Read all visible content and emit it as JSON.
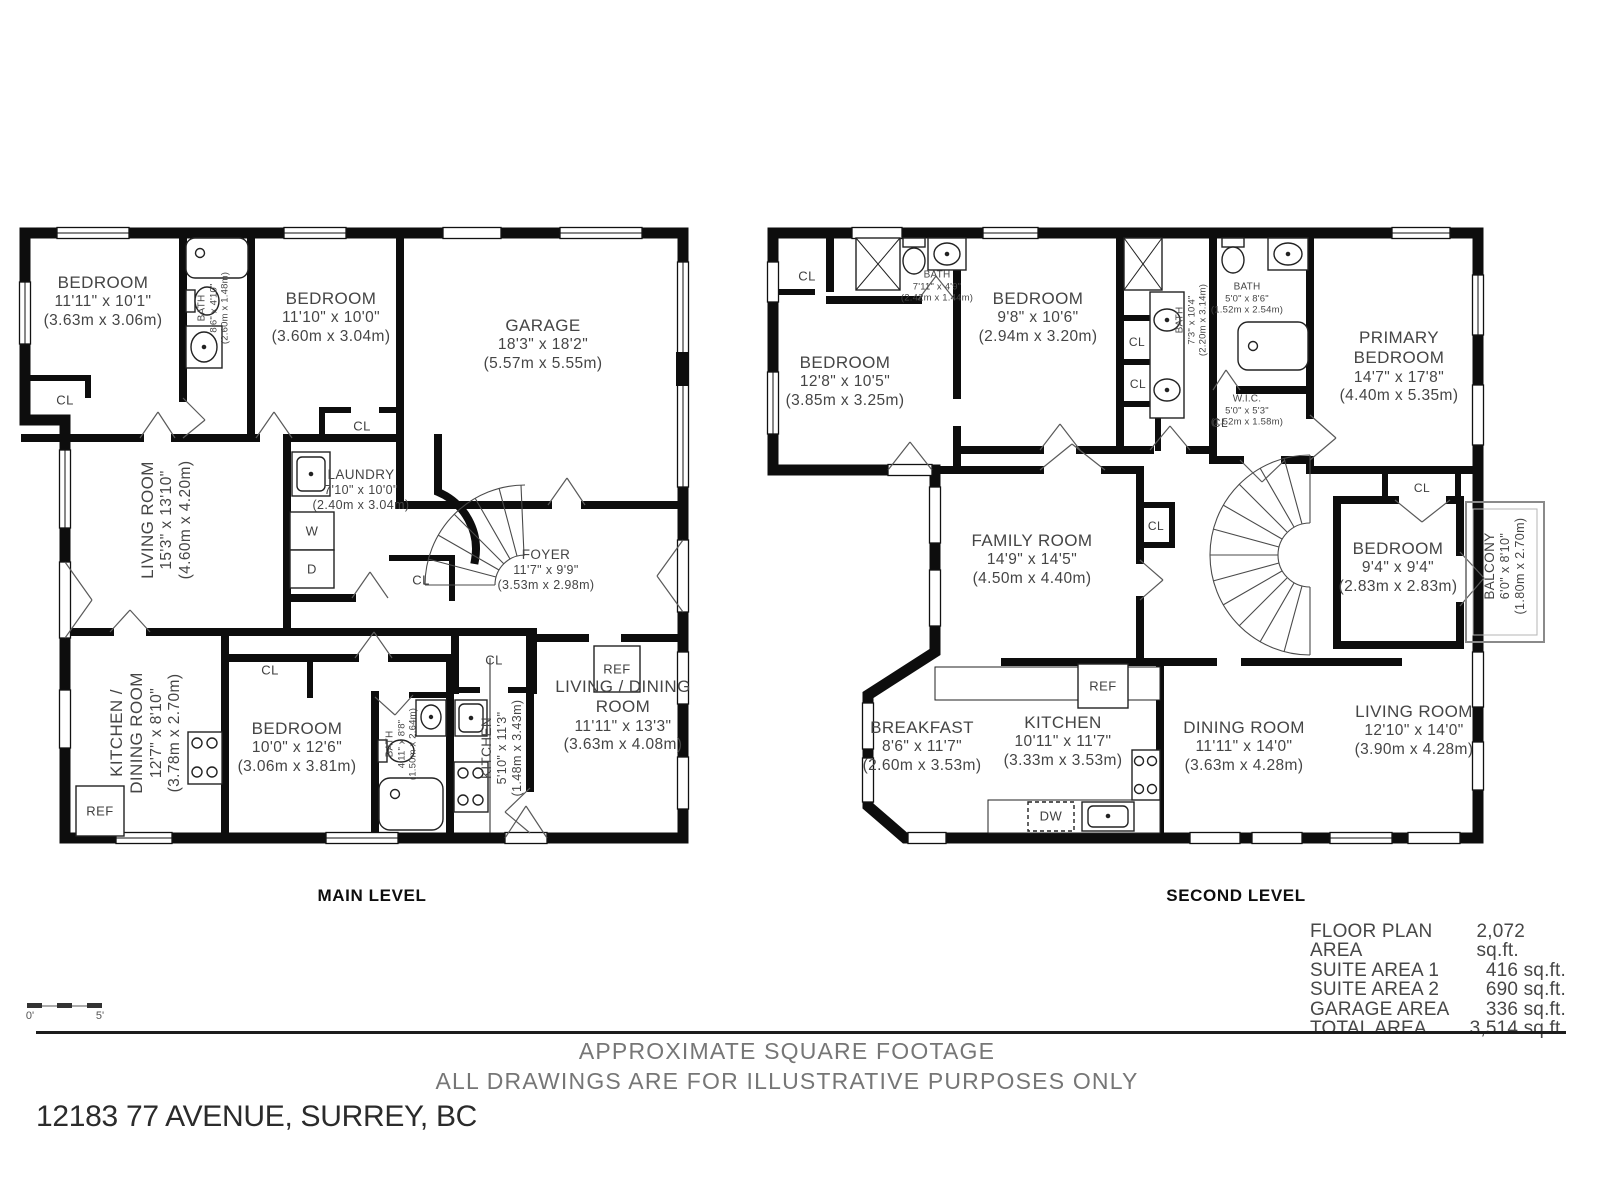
{
  "footer": {
    "caption_line1": "APPROXIMATE SQUARE FOOTAGE",
    "caption_line2": "ALL DRAWINGS ARE FOR ILLUSTRATIVE PURPOSES ONLY",
    "address": "12183 77 AVENUE, SURREY, BC",
    "scale": {
      "start": "0'",
      "end": "5'"
    }
  },
  "areas": {
    "rows": [
      {
        "label": "FLOOR PLAN AREA",
        "value": "2,072 sq.ft."
      },
      {
        "label": "SUITE AREA 1",
        "value": "416 sq.ft."
      },
      {
        "label": "SUITE AREA 2",
        "value": "690 sq.ft."
      },
      {
        "label": "GARAGE AREA",
        "value": "336 sq.ft."
      },
      {
        "label": "TOTAL AREA",
        "value": "3,514 sq.ft."
      }
    ]
  },
  "main_level": {
    "label": "MAIN LEVEL",
    "rooms": {
      "bedroom_1": {
        "name": "BEDROOM",
        "ft": "11'11\" x 10'1\"",
        "m": "(3.63m x 3.06m)"
      },
      "bath_1": {
        "name": "BATH",
        "ft": "8'6\" x 4'10\"",
        "m": "(2.60m x 1.48m)"
      },
      "bedroom_2": {
        "name": "BEDROOM",
        "ft": "11'10\" x 10'0\"",
        "m": "(3.60m x 3.04m)"
      },
      "garage": {
        "name": "GARAGE",
        "ft": "18'3\" x 18'2\"",
        "m": "(5.57m x 5.55m)"
      },
      "living_room": {
        "name": "LIVING ROOM",
        "ft": "15'3\" x 13'10\"",
        "m": "(4.60m x 4.20m)"
      },
      "laundry": {
        "name": "LAUNDRY",
        "ft": "7'10\" x 10'0\"",
        "m": "(2.40m x 3.04m)"
      },
      "foyer": {
        "name": "FOYER",
        "ft": "11'7\" x 9'9\"",
        "m": "(3.53m x 2.98m)"
      },
      "kitchen_dining": {
        "name": "KITCHEN /\nDINING ROOM",
        "ft": "12'7\" x 8'10\"",
        "m": "(3.78m x 2.70m)"
      },
      "bedroom_3": {
        "name": "BEDROOM",
        "ft": "10'0\" x 12'6\"",
        "m": "(3.06m x 3.81m)"
      },
      "bath_2": {
        "name": "BATH",
        "ft": "4'11\" x 8'8\"",
        "m": "(1.50m x 2.64m)"
      },
      "kitchen": {
        "name": "KITCHEN",
        "ft": "5'10\" x 11'3\"",
        "m": "(1.48m x 3.43m)"
      },
      "living_dining": {
        "name": "LIVING / DINING\nROOM",
        "ft": "11'11\" x 13'3\"",
        "m": "(3.63m x 4.08m)"
      }
    },
    "markers": {
      "cl": "CL",
      "w": "W",
      "d": "D",
      "ref": "REF"
    }
  },
  "second_level": {
    "label": "SECOND LEVEL",
    "rooms": {
      "bedroom_a": {
        "name": "BEDROOM",
        "ft": "12'8\" x 10'5\"",
        "m": "(3.85m x 3.25m)"
      },
      "bath_a": {
        "name": "BATH",
        "ft": "7'11\" x 4'9\"",
        "m": "(2.42m x 1.44m)"
      },
      "bedroom_b": {
        "name": "BEDROOM",
        "ft": "9'8\" x 10'6\"",
        "m": "(2.94m x 3.20m)"
      },
      "bath_b": {
        "name": "BATH",
        "ft": "7'3\" x 10'4\"",
        "m": "(2.20m x 3.14m)"
      },
      "bath_c": {
        "name": "BATH",
        "ft": "5'0\" x 8'6\"",
        "m": "(1.52m x 2.54m)"
      },
      "wic": {
        "name": "W.I.C.",
        "ft": "5'0\" x 5'3\"",
        "m": "(1.52m x 1.58m)"
      },
      "primary_bedroom": {
        "name": "PRIMARY\nBEDROOM",
        "ft": "14'7\" x 17'8\"",
        "m": "(4.40m x 5.35m)"
      },
      "family_room": {
        "name": "FAMILY ROOM",
        "ft": "14'9\" x 14'5\"",
        "m": "(4.50m x 4.40m)"
      },
      "bedroom_c": {
        "name": "BEDROOM",
        "ft": "9'4\" x 9'4\"",
        "m": "(2.83m x 2.83m)"
      },
      "balcony": {
        "name": "BALCONY",
        "ft": "6'0\" x 8'10\"",
        "m": "(1.80m x 2.70m)"
      },
      "breakfast": {
        "name": "BREAKFAST",
        "ft": "8'6\" x 11'7\"",
        "m": "(2.60m x 3.53m)"
      },
      "kitchen": {
        "name": "KITCHEN",
        "ft": "10'11\" x 11'7\"",
        "m": "(3.33m x 3.53m)"
      },
      "dining_room": {
        "name": "DINING ROOM",
        "ft": "11'11\" x 14'0\"",
        "m": "(3.63m x 4.28m)"
      },
      "living_room": {
        "name": "LIVING ROOM",
        "ft": "12'10\" x 14'0\"",
        "m": "(3.90m x 4.28m)"
      }
    },
    "markers": {
      "cl": "CL",
      "ref": "REF",
      "dw": "DW"
    }
  }
}
